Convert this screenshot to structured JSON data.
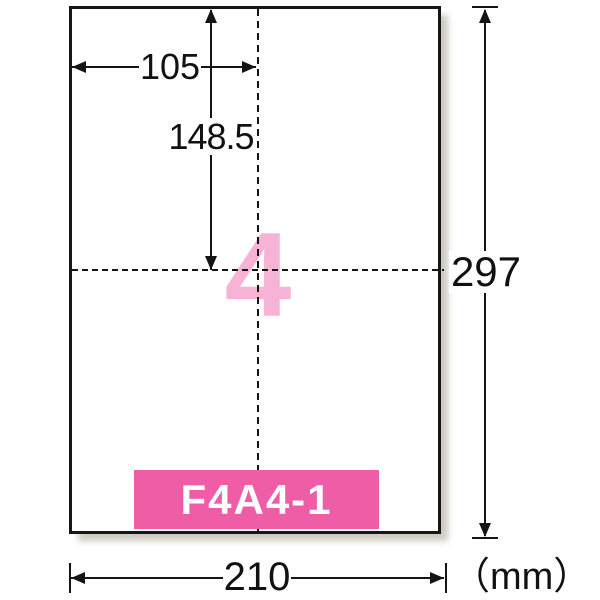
{
  "diagram": {
    "product_code": "F4A4-1",
    "labels_per_sheet": "4",
    "dims": {
      "sheet_width_mm": "210",
      "sheet_height_mm": "297",
      "label_width_mm": "105",
      "label_height_mm": "148.5",
      "unit_label": "（mm）"
    },
    "colors": {
      "banner_pink": "#ef5da7",
      "numeral_pink": "#f7b3d5",
      "ink": "#141414",
      "paper": "#ffffff",
      "shadow": "#a39f8e"
    },
    "icons": [
      "arrowhead-left-icon",
      "arrowhead-right-icon",
      "arrowhead-up-icon",
      "arrowhead-down-icon"
    ]
  }
}
